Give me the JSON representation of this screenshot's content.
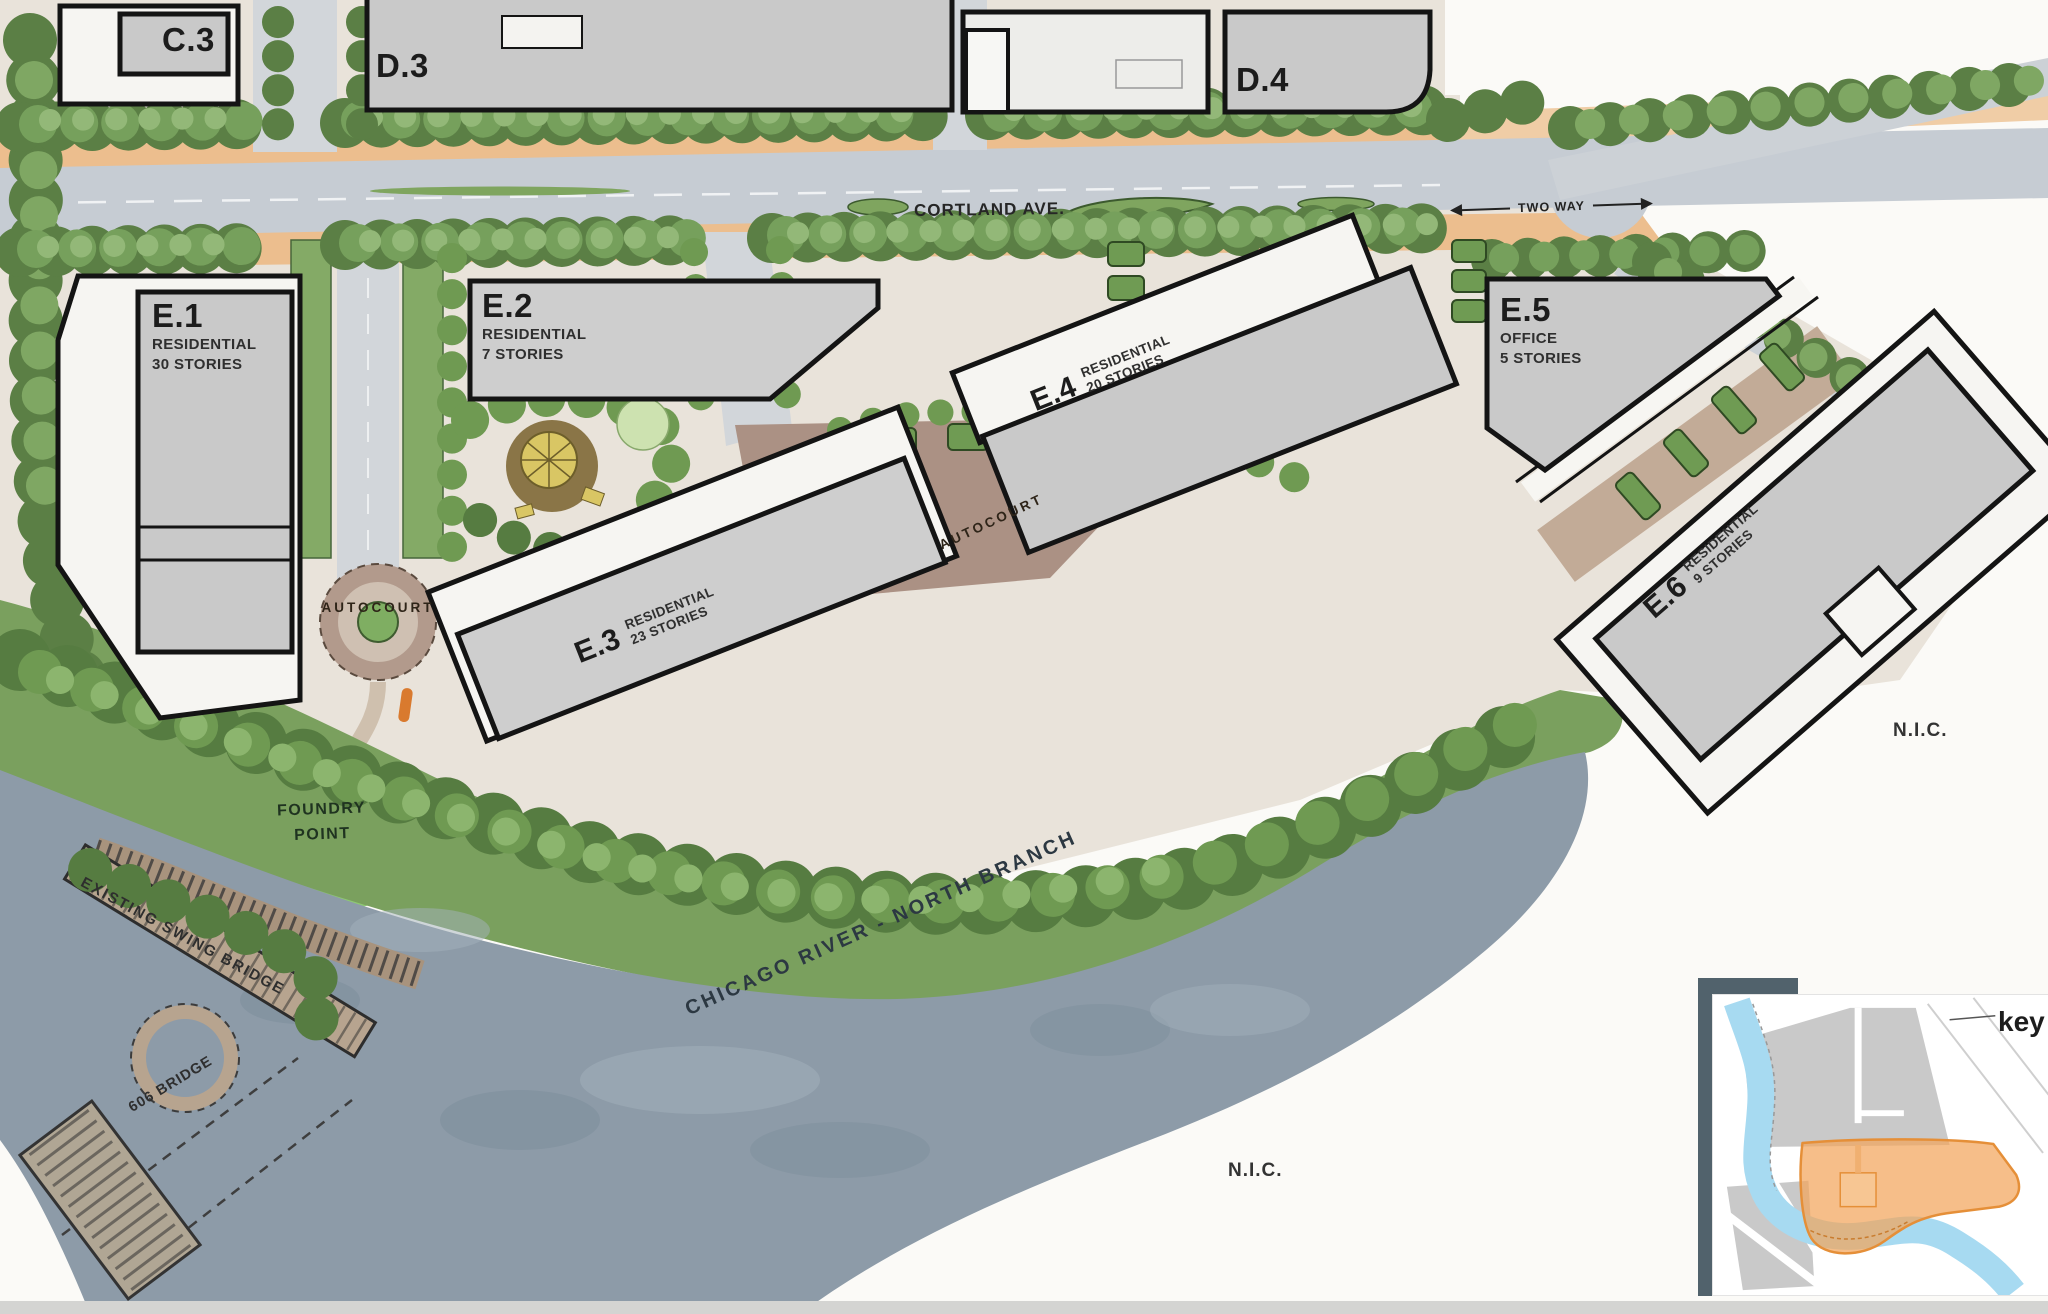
{
  "streets": {
    "cortland": "CORTLAND AVE.",
    "two_way": "TWO WAY"
  },
  "labels": {
    "autocourt_west": "AUTOCOURT",
    "autocourt_central": "AUTOCOURT",
    "foundry_point": "FOUNDRY\nPOINT",
    "swing_bridge": "EXISTING SWING BRIDGE",
    "bridge_606": "606 BRIDGE",
    "river": "CHICAGO RIVER - NORTH BRANCH",
    "nic_east": "N.I.C.",
    "nic_south": "N.I.C.",
    "key": "key"
  },
  "parcels": {
    "c3": {
      "id": "C.3"
    },
    "d3": {
      "id": "D.3"
    },
    "d4": {
      "id": "D.4"
    },
    "e1": {
      "id": "E.1",
      "use": "RESIDENTIAL",
      "stories": "30 STORIES"
    },
    "e2": {
      "id": "E.2",
      "use": "RESIDENTIAL",
      "stories": "7 STORIES"
    },
    "e3": {
      "id": "E.3",
      "use": "RESIDENTIAL",
      "stories": "23 STORIES"
    },
    "e4": {
      "id": "E.4",
      "use": "RESIDENTIAL",
      "stories": "20 STORIES"
    },
    "e5": {
      "id": "E.5",
      "use": "OFFICE",
      "stories": "5 STORIES"
    },
    "e6": {
      "id": "E.6",
      "use": "RESIDENTIAL",
      "stories": "9 STORIES"
    }
  },
  "colors": {
    "water": "#8d9ba8",
    "bank_green": "#7aa05e",
    "park_green": "#8ec873",
    "road_gray": "#c6ccd3",
    "parkway_orange": "#ecbe8e",
    "building_gray": "#c9c9c9",
    "parcel_white": "#f6f5f2",
    "key_highlight_orange": "#f3a55c",
    "key_river_blue": "#a7daf1"
  }
}
